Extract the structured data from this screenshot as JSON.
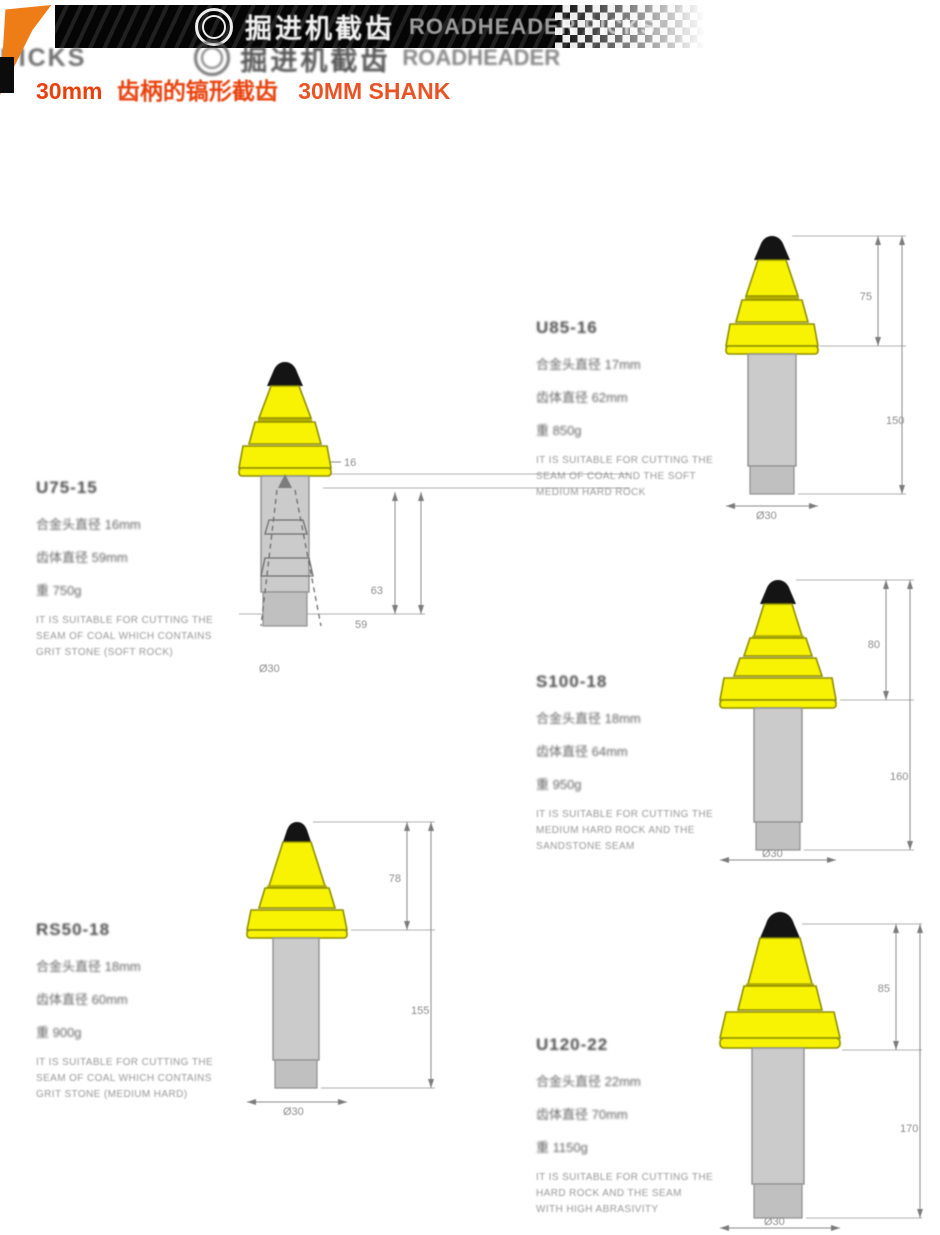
{
  "header": {
    "title_cn": "掘进机截齿",
    "title_en": "ROADHEADER PICKS",
    "ghost_left": "PICKS",
    "ghost_cn": "掘进机截齿",
    "ghost_en": "ROADHEADER",
    "subtitle_prefix": "30mm",
    "subtitle_cn": "齿柄的镐形截齿",
    "subtitle_en": "30MM SHANK",
    "accent_color": "#e8410c",
    "banner_color": "#0a0a0a",
    "wedge_color": "#ee7d17"
  },
  "products": [
    {
      "model": "U75-15",
      "specs": [
        "合金头直径 16mm",
        "齿体直径 59mm",
        "重 750g"
      ],
      "desc": [
        "IT IS SUITABLE FOR CUTTING THE",
        "SEAM OF COAL WHICH CONTAINS",
        "GRIT STONE (SOFT ROCK)"
      ],
      "dims": {
        "d1": "16",
        "d2": "63",
        "d3": "59",
        "bottom": "Ø30"
      }
    },
    {
      "model": "U85-16",
      "specs": [
        "合金头直径 17mm",
        "齿体直径 62mm",
        "重 850g"
      ],
      "desc": [
        "IT IS SUITABLE FOR CUTTING THE",
        "SEAM OF COAL AND THE SOFT",
        "MEDIUM HARD ROCK"
      ],
      "dims": {
        "d1": "75",
        "d2": "150",
        "bottom": "Ø30"
      }
    },
    {
      "model": "S100-18",
      "specs": [
        "合金头直径 18mm",
        "齿体直径 64mm",
        "重 950g"
      ],
      "desc": [
        "IT IS SUITABLE FOR CUTTING THE",
        "MEDIUM HARD ROCK AND THE",
        "SANDSTONE SEAM"
      ],
      "dims": {
        "d1": "80",
        "d2": "160",
        "bottom": "Ø30"
      }
    },
    {
      "model": "RS50-18",
      "specs": [
        "合金头直径 18mm",
        "齿体直径 60mm",
        "重 900g"
      ],
      "desc": [
        "IT IS SUITABLE FOR CUTTING THE",
        "SEAM OF COAL WHICH CONTAINS",
        "GRIT STONE (MEDIUM HARD)"
      ],
      "dims": {
        "d1": "78",
        "d2": "155",
        "bottom": "Ø30"
      }
    },
    {
      "model": "U120-22",
      "specs": [
        "合金头直径 22mm",
        "齿体直径 70mm",
        "重 1150g"
      ],
      "desc": [
        "IT IS SUITABLE FOR CUTTING THE",
        "HARD ROCK AND THE SEAM",
        "WITH HIGH ABRASIVITY"
      ],
      "dims": {
        "d1": "85",
        "d2": "170",
        "bottom": "Ø30"
      }
    }
  ],
  "drawing_colors": {
    "head": "#f7f303",
    "tip": "#141414",
    "shank": "#cbcbcb"
  }
}
